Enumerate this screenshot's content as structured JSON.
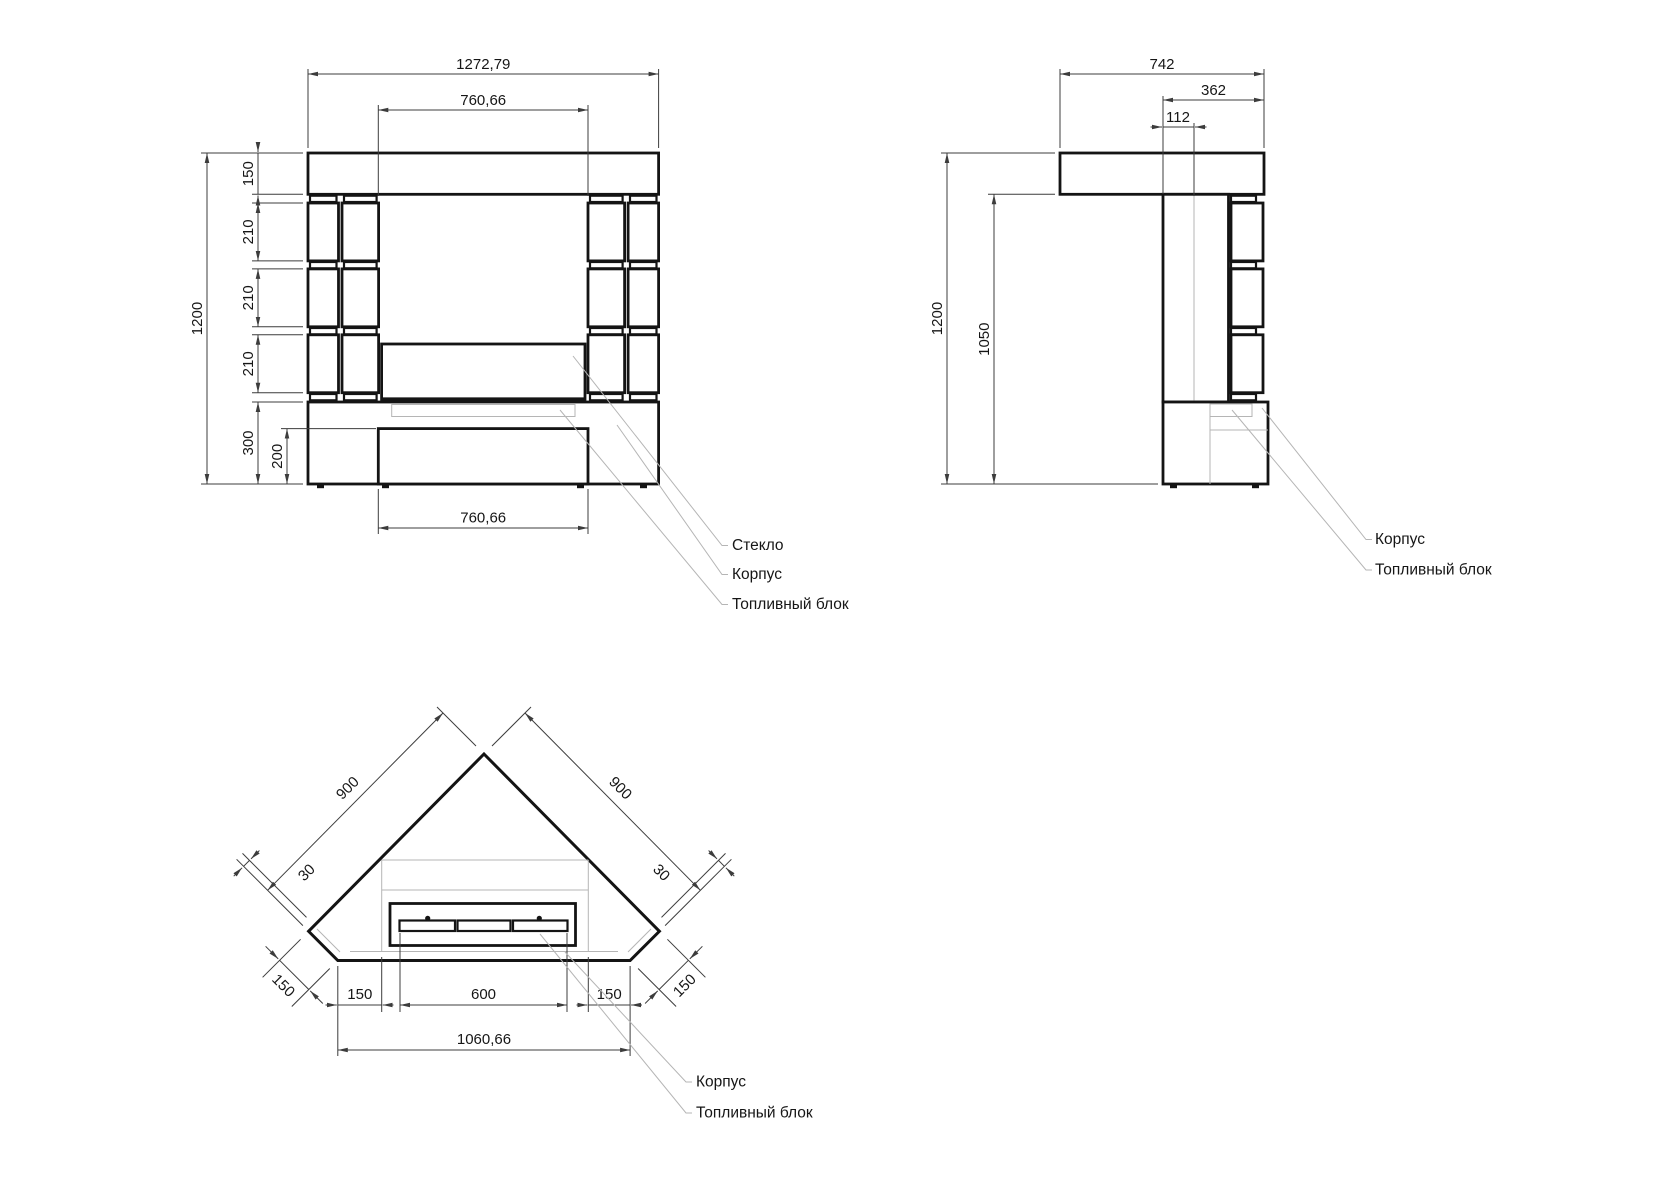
{
  "front": {
    "dim_overall_width": "1272,79",
    "dim_opening_width": "760,66",
    "dim_total_height": "1200",
    "dim_mantel_height": "150",
    "dim_block1": "210",
    "dim_block2": "210",
    "dim_block3": "210",
    "dim_base_height": "300",
    "dim_panel_height": "200",
    "dim_bottom_width": "760,66",
    "label_glass": "Стекло",
    "label_body": "Корпус",
    "label_fuel": "Топливный блок"
  },
  "side": {
    "dim_depth": "742",
    "dim_body_depth": "362",
    "dim_offset": "112",
    "dim_total_height": "1200",
    "dim_body_height": "1050",
    "label_body": "Корпус",
    "label_fuel": "Топливный блок"
  },
  "top": {
    "dim_side_left": "900",
    "dim_side_right": "900",
    "dim_offset_left": "30",
    "dim_offset_right": "30",
    "dim_chamfer_left": "150",
    "dim_chamfer_right": "150",
    "dim_inset_left": "150",
    "dim_burner": "600",
    "dim_inset_right": "150",
    "dim_bottom_width": "1060,66",
    "label_body": "Корпус",
    "label_fuel": "Топливный блок"
  }
}
